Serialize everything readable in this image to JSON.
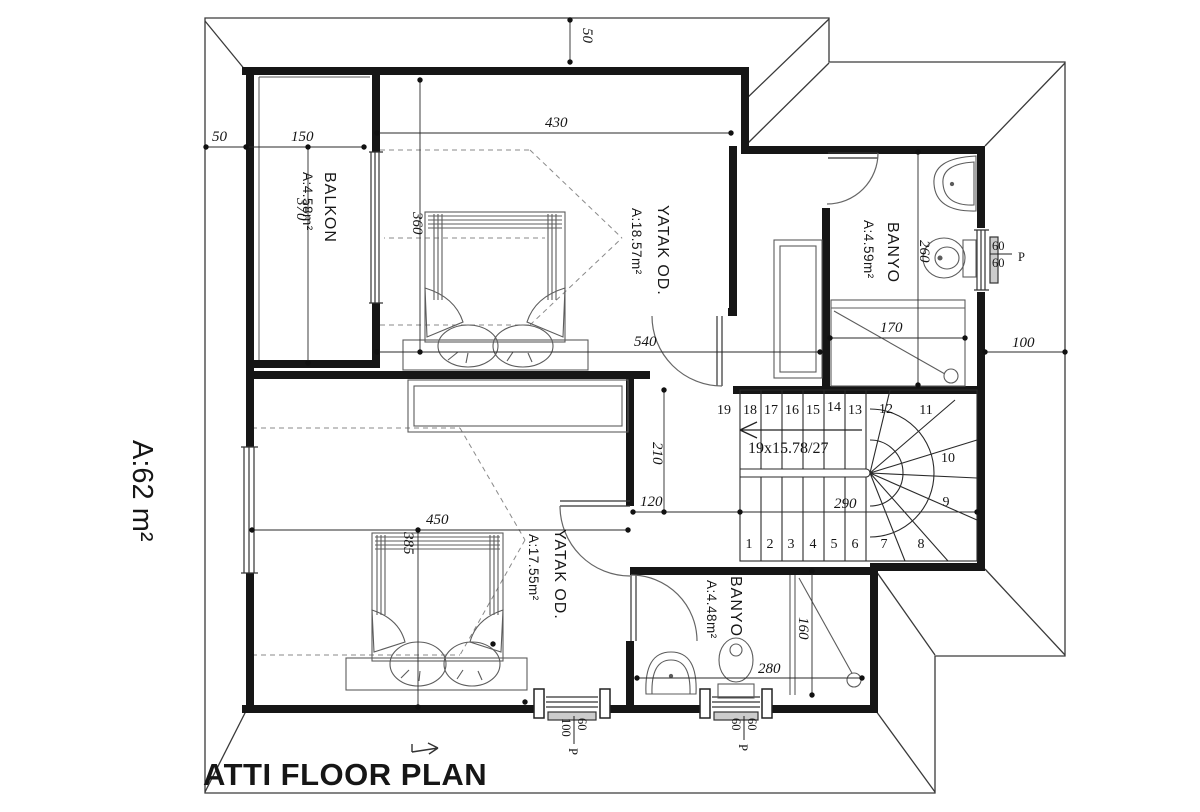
{
  "title": "ATTI FLOOR PLAN",
  "total_area": "A:62 m²",
  "rooms": {
    "balkon": {
      "name": "BALKON",
      "area": "A:4.58m²"
    },
    "yatak1": {
      "name": "YATAK OD.",
      "area": "A:18.57m²"
    },
    "banyo1": {
      "name": "BANYO",
      "area": "A:4.59m²"
    },
    "yatak2": {
      "name": "YATAK OD.",
      "area": "A:17.55m²"
    },
    "banyo2": {
      "name": "BANYO",
      "area": "A:4.48m²"
    }
  },
  "stairs": {
    "spec": "19x15.78/27",
    "treads": [
      "1",
      "2",
      "3",
      "4",
      "5",
      "6",
      "7",
      "8",
      "9",
      "10",
      "11",
      "12",
      "13",
      "14",
      "15",
      "16",
      "17",
      "18",
      "19"
    ]
  },
  "dims": {
    "eave_top": "50",
    "eave_left": "50",
    "balkon_w": "150",
    "yatak1_w": "430",
    "yatak1_d": "360",
    "balkon_d": "370",
    "mid_w": "540",
    "banyo1_shower_w": "170",
    "eave_right": "100",
    "banyo1_d": "260",
    "hall_d": "210",
    "hall_w": "120",
    "stair_w": "290",
    "yatak2_w": "450",
    "yatak2_d": "385",
    "banyo2_shower_d": "160",
    "banyo2_w": "280"
  },
  "windows": {
    "banyo1": {
      "a": "60",
      "b": "60",
      "p": "P"
    },
    "yatak2": {
      "a": "60",
      "b": "100",
      "p": "P"
    },
    "banyo2": {
      "a": "60",
      "b": "60",
      "p": "P"
    }
  }
}
